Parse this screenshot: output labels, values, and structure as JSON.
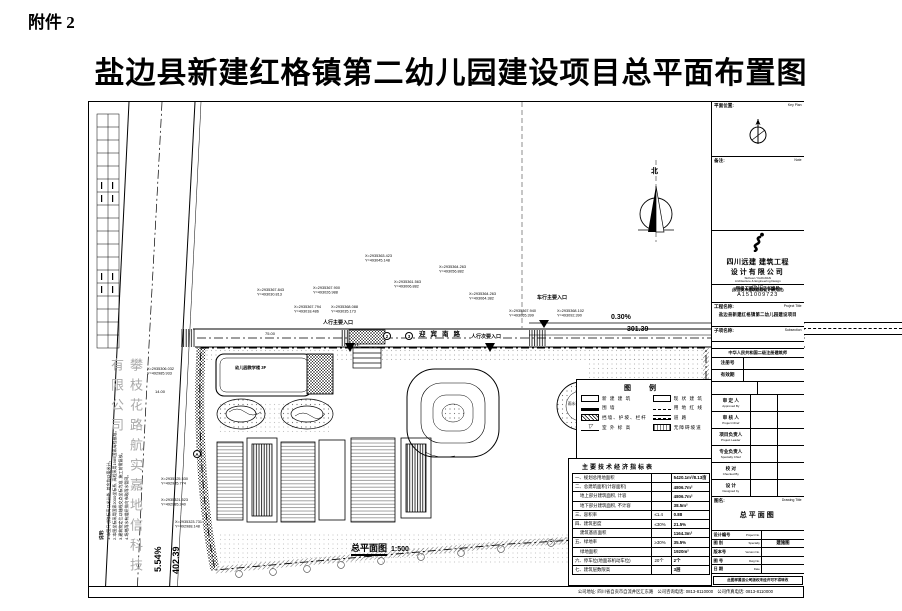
{
  "page": {
    "attachment_label": "附件 2",
    "title": "盐边县新建红格镇第二幼儿园建设项目总平面布置图"
  },
  "plan": {
    "north_label": "北",
    "road_name": "迎宾南路",
    "scale_title": "总平面图",
    "scale_value": "1:500",
    "right_road_grade": "0.30%",
    "right_road_length": "301.39",
    "left_road_grade": "5.54%",
    "left_road_length": "402.39",
    "entrance_vehicle": "车行主要入口",
    "entrance_ped_main": "人行主要入口",
    "entrance_ped_secondary": "人行次要入口",
    "pond_label": "雨水调蓄池现状",
    "building_label": "幼儿园教学楼 3F",
    "dim_a": "14.00",
    "dim_b": "75.00",
    "axis_2": "2",
    "axis_3": "3",
    "axis_a": "A",
    "watermark_side": "攀枝花路航实嘉地信科技有限公司",
    "notes_title": "说明:",
    "notes_lines": [
      "1.本图尺寸除标高以米计外, 其余均以毫米计。",
      "2.本图坐标采用国家2000坐标系, 高程采用1985国家高程基准。",
      "3.建筑物定位以轴线交点坐标为准, 施工前需复核。",
      "4.场地雨水有组织排向市政雨水管网。"
    ],
    "coords": [
      {
        "x": "X=2935367.843",
        "y": "Y=493030.813"
      },
      {
        "x": "X=2935367.900",
        "y": "Y=493026.988"
      },
      {
        "x": "X=2935367.794",
        "y": "Y=493018.486"
      },
      {
        "x": "X=2935368.088",
        "y": "Y=493035.173"
      },
      {
        "x": "X=2935363.423",
        "y": "Y=493045.148"
      },
      {
        "x": "X=2935364.263",
        "y": "Y=493056.882"
      },
      {
        "x": "X=2935361.563",
        "y": "Y=493006.882"
      },
      {
        "x": "X=2935364.263",
        "y": "Y=493064.382"
      },
      {
        "x": "X=2935367.940",
        "y": "Y=493065.399"
      },
      {
        "x": "X=2935368.102",
        "y": "Y=493092.390"
      },
      {
        "x": "X=2935306.032",
        "y": "Y=492985.933"
      },
      {
        "x": "X=2935325.530",
        "y": "Y=492985.774"
      },
      {
        "x": "X=2935321.523",
        "y": "Y=492985.240"
      },
      {
        "x": "X=2935323.731",
        "y": "Y=492988.148"
      }
    ]
  },
  "legend": {
    "title": "图  例",
    "items": [
      {
        "symbol": "new-building",
        "label": "新 建 建 筑"
      },
      {
        "symbol": "existing-building",
        "label": "现 状 建 筑"
      },
      {
        "symbol": "wall",
        "label": "围  墙"
      },
      {
        "symbol": "red-line",
        "label": "用 地 红 线"
      },
      {
        "symbol": "retaining-slope",
        "label": "挡墙、护坡、栏杆"
      },
      {
        "symbol": "road",
        "label": "道  路"
      },
      {
        "symbol": "site-level",
        "label": "室 外 标 高"
      },
      {
        "symbol": "ramp",
        "label": "无障碍坡道"
      }
    ]
  },
  "indicators": {
    "title": "主要技术经济指标表",
    "rows": [
      {
        "no": "一、",
        "label": "规划总用地面积",
        "limit": "",
        "value": "5420.1m²/8.13亩"
      },
      {
        "no": "二、",
        "label": "总建筑面积(计容面积)",
        "limit": "",
        "value": "4806.7m²"
      },
      {
        "no": "",
        "label": "地上部分建筑面积, 计容",
        "limit": "",
        "value": "4806.7m²"
      },
      {
        "no": "",
        "label": "地下部分建筑面积, 不计容",
        "limit": "",
        "value": "38.5m²"
      },
      {
        "no": "三、",
        "label": "容积率",
        "limit": "≤1.4",
        "value": "0.88"
      },
      {
        "no": "四、",
        "label": "建筑密度",
        "limit": "≤30%",
        "value": "21.5%"
      },
      {
        "no": "",
        "label": "建筑基底面积",
        "limit": "",
        "value": "1164.3m²"
      },
      {
        "no": "五、",
        "label": "绿地率",
        "limit": "≥30%",
        "value": "35.5%"
      },
      {
        "no": "",
        "label": "绿地面积",
        "limit": "",
        "value": "1920m²"
      },
      {
        "no": "六、",
        "label": "停车位(地面非机动车位)",
        "limit": "20个",
        "value": "2个"
      },
      {
        "no": "七、",
        "label": "建筑层数限高",
        "limit": "",
        "value": "3层"
      }
    ]
  },
  "titleblock": {
    "keyplan_cn": "平面位置:",
    "keyplan_en": "Key Plan",
    "note_cn": "备注:",
    "note_en": "Note",
    "company": {
      "cn_line1": "四川远建 建筑工程",
      "cn_line2": "设计有限公司",
      "en_line1": "Sichuan  YUANJIAN",
      "en_line2": "Architecture & Engineering Design",
      "en_line3": "Co. LTD",
      "former": "(原自贡市建筑勘察设计研究院)"
    },
    "cert_label": "甲级工程设计证书编号",
    "cert_no": "A151009723",
    "project_label_cn": "工程名称:",
    "project_label_en": "Project Title",
    "project_name": "盐边县新建红格镇第二幼儿园建设项目",
    "sub_label_cn": "子项名称:",
    "sub_label_en": "Subsection",
    "reg_header": "中华人民共和国二级注册建筑师",
    "reg_no_label": "注册号",
    "reg_valid_label": "有效期",
    "signatures": [
      {
        "cn": "审 定 人",
        "en": "Approved By"
      },
      {
        "cn": "审 核 人",
        "en": "Project Chief"
      },
      {
        "cn": "项目负责人",
        "en": "Project Leader"
      },
      {
        "cn": "专业负责人",
        "en": "Specialty Chief"
      },
      {
        "cn": "校  对",
        "en": "Checked By"
      },
      {
        "cn": "设  计",
        "en": "Designed by"
      }
    ],
    "drawing_title_label_cn": "图名:",
    "drawing_title_label_en": "Drawing Title",
    "drawing_title": "总平面图",
    "bottom_rows": [
      {
        "cn": "设计编号",
        "en": "Project No.",
        "value": ""
      },
      {
        "cn": "图  别",
        "en": "Specialty",
        "value": "建施图"
      },
      {
        "cn": "版本号",
        "en": "Version No.",
        "value": ""
      },
      {
        "cn": "图  号",
        "en": "Dwg No.",
        "value": ""
      },
      {
        "cn": "日  期",
        "en": "Date",
        "value": ""
      }
    ],
    "copyright_note": "此图样属该公司版权未经许可不得转改",
    "footer": "公司地址: 四川省自贡市自流井区汇东路　公司咨询电话: 0813-8110000　公司传真电话: 0813-8110000"
  }
}
